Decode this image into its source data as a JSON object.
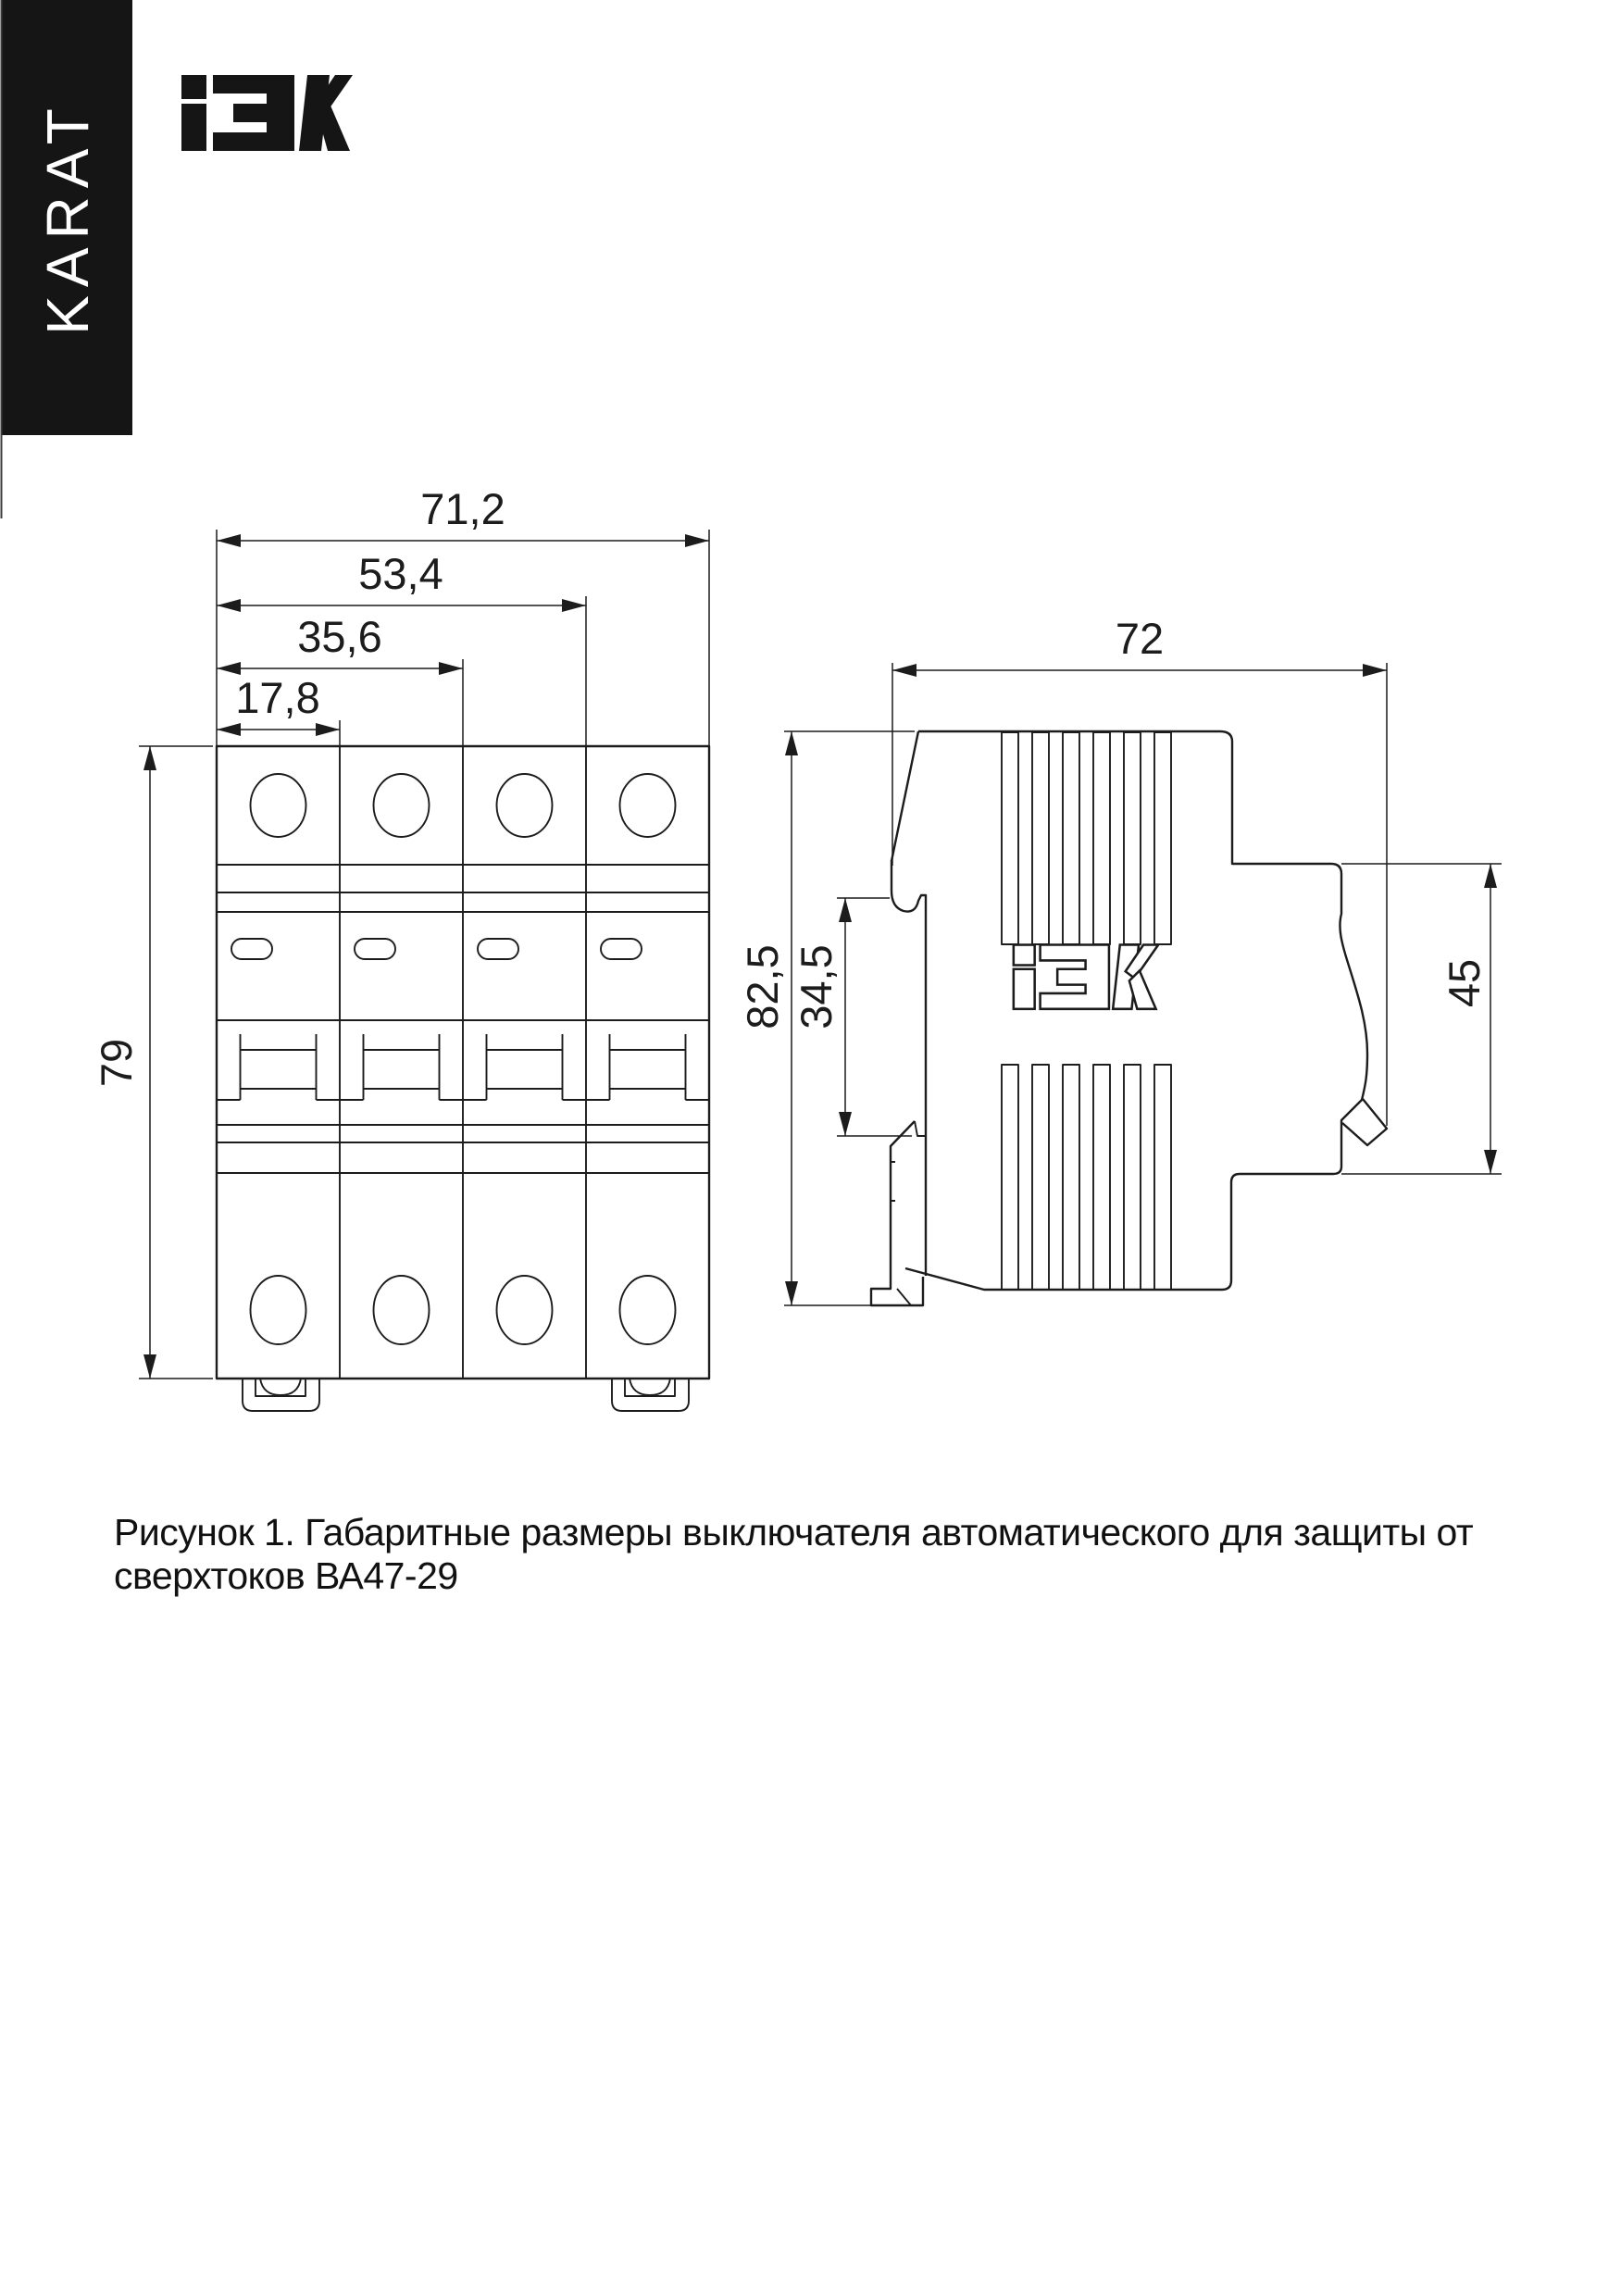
{
  "brand": {
    "vertical_label": "KARAT",
    "logo_name": "IEK"
  },
  "figure": {
    "front_view": {
      "dim_width_total": "71,2",
      "dim_width_three_modules": "53,4",
      "dim_width_two_modules": "35,6",
      "dim_width_one_module": "17,8",
      "dim_height": "79"
    },
    "side_view": {
      "dim_depth": "72",
      "dim_height": "82,5",
      "dim_rail_span": "34,5",
      "dim_lower_depth": "45"
    }
  },
  "caption": "Рисунок 1. Габаритные размеры выключателя автоматического для защиты от сверхтоков ВА47-29"
}
